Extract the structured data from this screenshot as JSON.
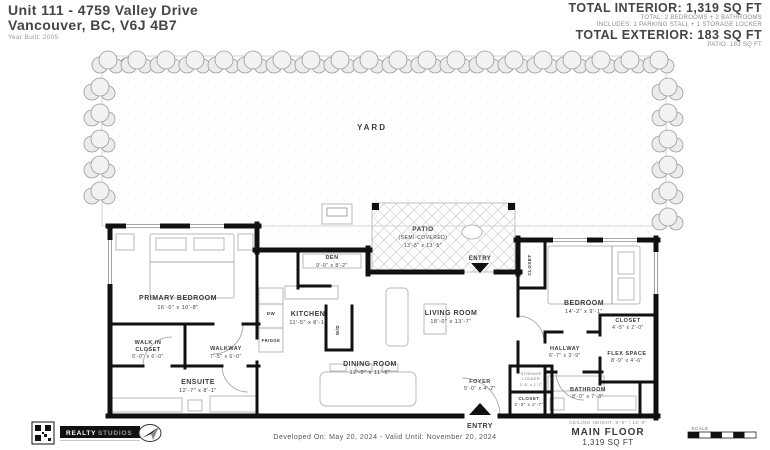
{
  "header": {
    "address_line1": "Unit 111 - 4759 Valley Drive",
    "address_line2": "Vancouver, BC, V6J 4B7",
    "year_built": "Year Built: 2005",
    "total_interior": "TOTAL INTERIOR: 1,319 SQ FT",
    "interior_detail1": "TOTAL: 2 BEDROOMS + 2 BATHROOMS",
    "interior_detail2": "INCLUDES: 1 PARKING STALL + 1 STORAGE LOCKER",
    "total_exterior": "TOTAL EXTERIOR: 183 SQ FT",
    "exterior_detail": "PATIO: 183 SQ FT"
  },
  "plan": {
    "yard_label": "YARD",
    "patio": {
      "name": "PATIO",
      "sub": "(SEMI-COVERED)",
      "dims": "13'-5\" x 13'-5\""
    },
    "rooms": [
      {
        "name": "PRIMARY BEDROOM",
        "dims": "16'-0\" x 10'-8\""
      },
      {
        "name": "WALK IN",
        "name2": "CLOSET",
        "dims": "6'-0\" x 6'-0\""
      },
      {
        "name": "WALKWAY",
        "dims": "7'-5\" x 6'-0\""
      },
      {
        "name": "ENSUITE",
        "dims": "12'-7\" x 8'-1\""
      },
      {
        "name": "DEN",
        "dims": "9'-0\" x 8'-2\""
      },
      {
        "name": "KITCHEN",
        "dims": "11'-5\" x 8'-1\""
      },
      {
        "name": "DINING ROOM",
        "dims": "12'-0\" x 11'-6\""
      },
      {
        "name": "LIVING ROOM",
        "dims": "18'-0\" x 13'-7\""
      },
      {
        "name": "BEDROOM",
        "dims": "14'-2\" x 9'-1\""
      },
      {
        "name": "CLOSET",
        "dims": "4'-5\" x 2'-0\""
      },
      {
        "name": "HALLWAY",
        "dims": "6'-7\" x 3'-9\""
      },
      {
        "name": "FLEX SPACE",
        "dims": "8'-9\" x 4'-6\""
      },
      {
        "name": "BATHROOM",
        "dims": "8'-0\" x 7'-3\""
      },
      {
        "name": "FOYER",
        "dims": "5'-0\" x 4'-2\""
      },
      {
        "name": "CLOSET",
        "dims": "2'-0\" x 2'-7\""
      }
    ],
    "fixtures": {
      "dw": "DW",
      "fridge": "FRIDGE",
      "wd": "W/D",
      "bedroom_closet_vertical": "CLOSET",
      "storage_line1": "STORAGE",
      "storage_line2": "LOCKER",
      "storage_dims": "2'-5\" x 2'-7\""
    },
    "patio_entry_label": "ENTRY",
    "main_entry_label": "ENTRY"
  },
  "footer": {
    "developed": "Developed On: May 20, 2024 - Valid Until: November 20, 2024",
    "ceiling": "CEILING HEIGHT: 8'-0\" / 14'-0\"",
    "floor_name": "MAIN FLOOR",
    "floor_area": "1,319 SQ FT",
    "scale_label": "SCALE",
    "logo_line1": "REALTY",
    "logo_line2": "STUDIOS"
  },
  "colors": {
    "wall": "#111111",
    "label": "#3c3c3c",
    "hedge": "#ececec",
    "accent": "#000000"
  }
}
